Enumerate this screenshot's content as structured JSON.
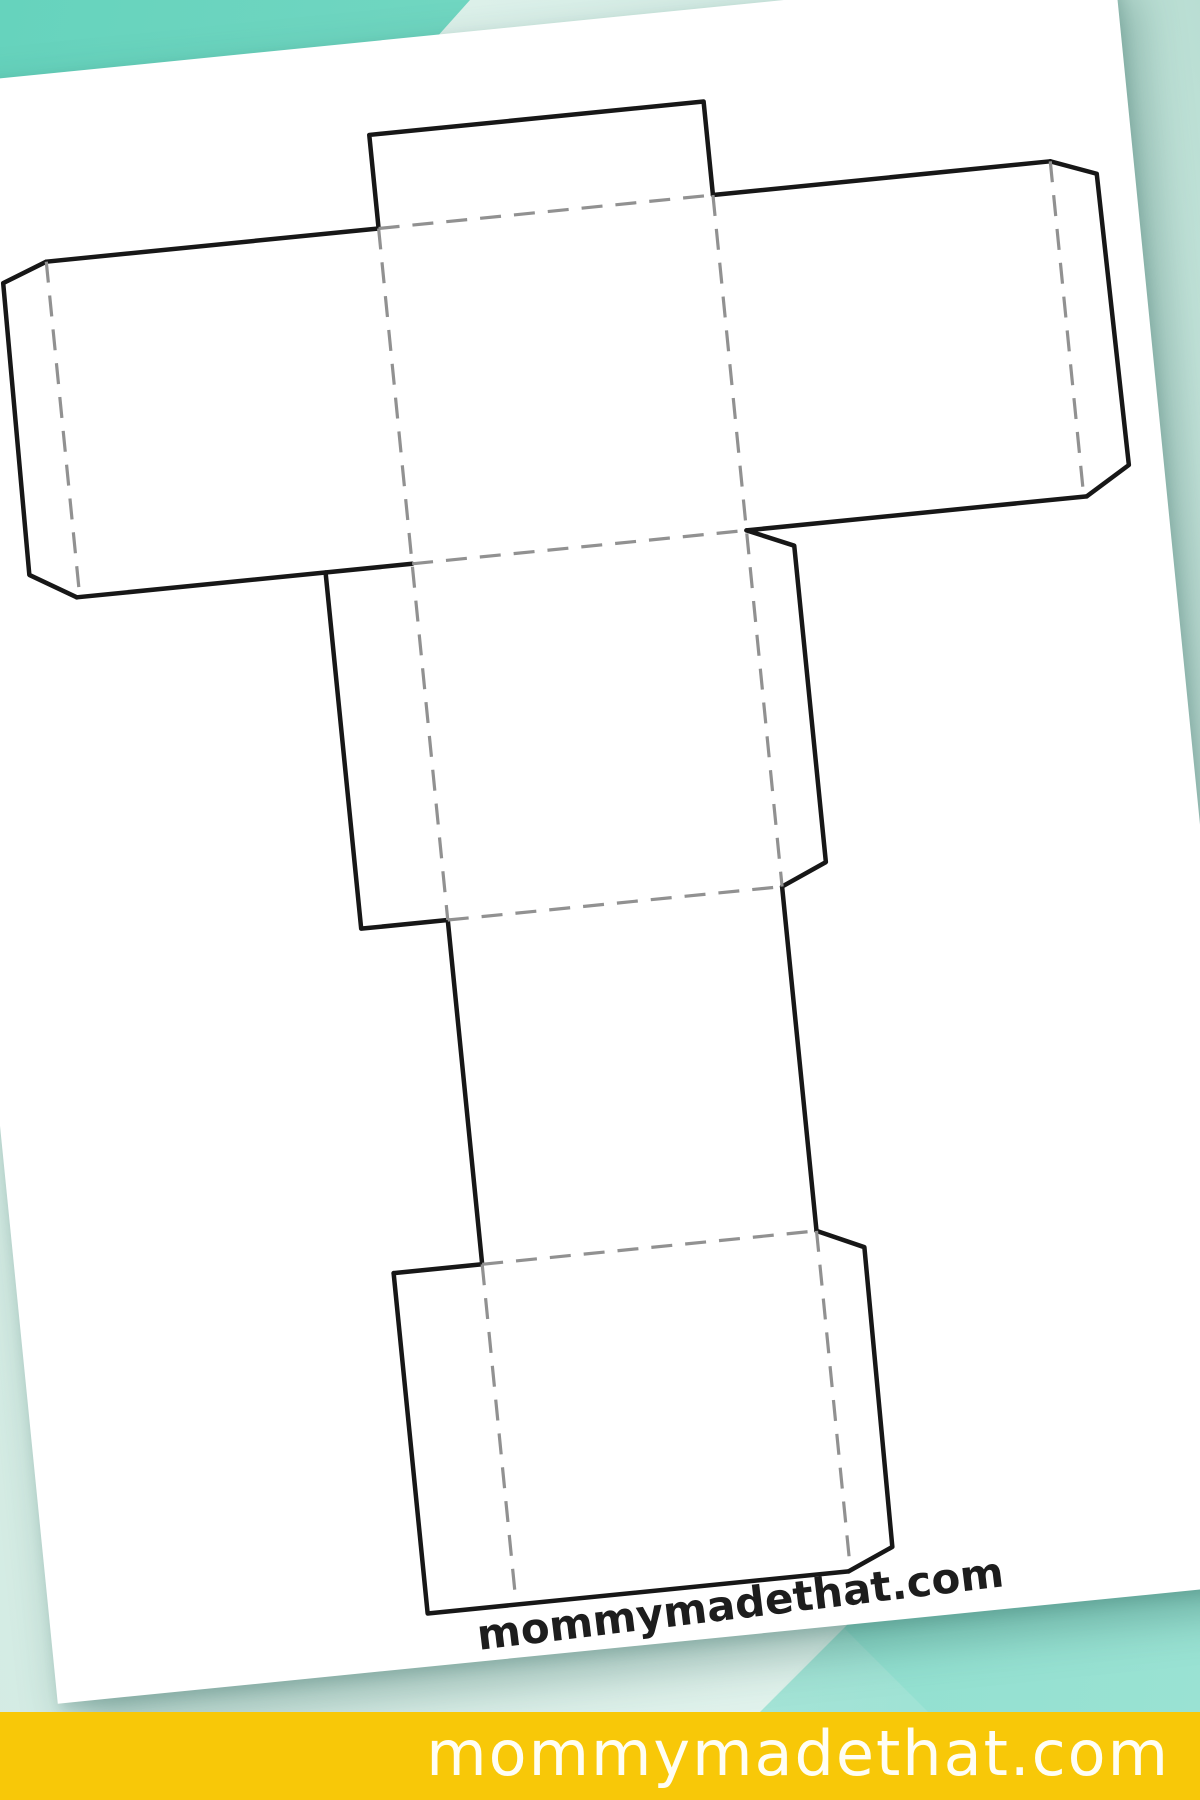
{
  "page": {
    "kind": "printable-papercraft-pin",
    "colors": {
      "teal_bright": "#6fd6c2",
      "teal_pale": "#d6eee7",
      "footer_yellow": "#f8c808",
      "paper": "#ffffff",
      "cut_line": "#171717",
      "fold_line": "#919191",
      "footer_text": "#fffef4",
      "watermark_text": "#1d1d1d"
    }
  },
  "template": {
    "name": "3d-letter-T-box-template-net",
    "line_styles": {
      "cut": "solid",
      "fold": "dashed"
    }
  },
  "paper": {
    "watermark_text": "mommymadethat.com"
  },
  "footer": {
    "site_text": "mommymadethat.com"
  }
}
